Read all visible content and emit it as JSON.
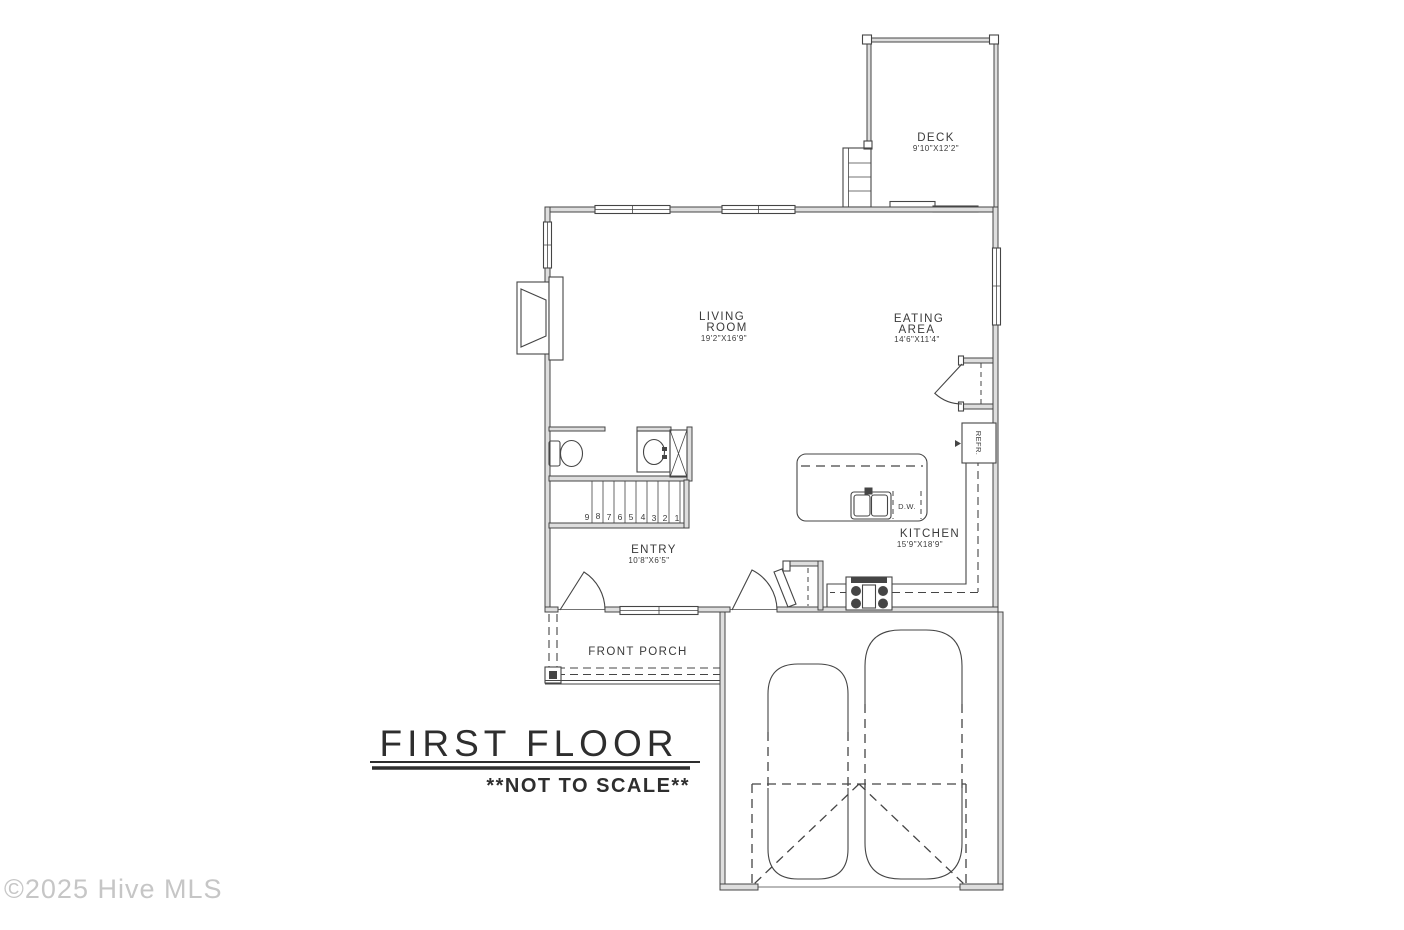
{
  "watermark": "©2025 Hive MLS",
  "title": {
    "heading": "FIRST FLOOR",
    "note": "**NOT TO SCALE**"
  },
  "rooms": {
    "deck": {
      "name": "DECK",
      "dims": "9'10\"X12'2\""
    },
    "living_room": {
      "line1": "LIVING",
      "line2": "ROOM",
      "dims": "19'2\"X16'9\""
    },
    "eating_area": {
      "line1": "EATING",
      "line2": "AREA",
      "dims": "14'6\"X11'4\""
    },
    "kitchen": {
      "name": "KITCHEN",
      "dims": "15'9\"X18'9\""
    },
    "entry": {
      "name": "ENTRY",
      "dims": "10'8\"X6'5\""
    },
    "front_porch": {
      "name": "FRONT PORCH"
    }
  },
  "fixtures": {
    "refrigerator": "REFR.",
    "dishwasher": "D.W."
  },
  "stairs": {
    "numbers": [
      "9",
      "8",
      "7",
      "6",
      "5",
      "4",
      "3",
      "2",
      "1"
    ]
  },
  "colors": {
    "line": "#454545",
    "wall_fill": "#dedede",
    "background": "#ffffff",
    "watermark": "#c6c6c6",
    "text": "#3b3b3b"
  }
}
